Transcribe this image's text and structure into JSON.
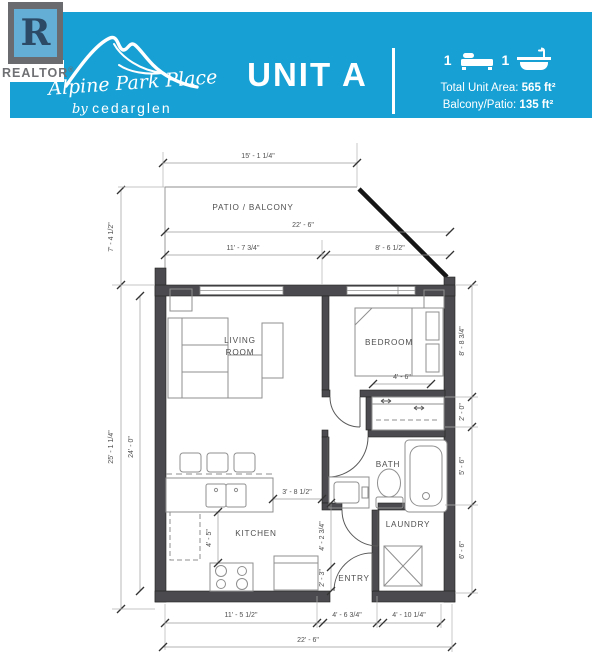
{
  "colors": {
    "accent_teal": "#16a0d4",
    "wall_gray": "#4b4b4f",
    "logo_blue": "#64aed6",
    "logo_gray": "#696b6e"
  },
  "header": {
    "unit_title": "UNIT A",
    "bed_count": "1",
    "bath_count": "1",
    "total_area_label": "Total Unit Area:",
    "total_area_value": "565 ft²",
    "balcony_label": "Balcony/Patio:",
    "balcony_value": "135 ft²",
    "realtor_r": "R",
    "realtor_word": "REALTOR",
    "brand_name": "Alpine Park Place",
    "brand_by": "by",
    "brand_builder": "cedarglen"
  },
  "plan": {
    "rooms": {
      "patio": "PATIO / BALCONY",
      "living_1": "LIVING",
      "living_2": "ROOM",
      "bedroom": "BEDROOM",
      "kitchen": "KITCHEN",
      "bath": "BATH",
      "laundry": "LAUNDRY",
      "entry": "ENTRY"
    },
    "dims": {
      "top_width": "15' - 1 1/4\"",
      "patio_depth": "7' - 4 1/2\"",
      "patio_width": "22' - 6\"",
      "living_width": "11' - 7 3/4\"",
      "bedroom_width": "8' - 6 1/2\"",
      "left_overall": "25' - 1 1/4\"",
      "left_inner": "24' - 0\"",
      "closet_width": "4' - 6\"",
      "right_bedroom": "8' - 8 3/4\"",
      "right_closet": "2' - 0\"",
      "right_bath": "5' - 6\"",
      "right_laundry": "6' - 6\"",
      "kitchen_pass": "3' - 8 1/2\"",
      "kitchen_depth": "4' - 5\"",
      "hall_depth": "4' - 2 3/4\"",
      "entry_depth": "2' - 3\"",
      "bottom_left": "11' - 5 1/2\"",
      "bottom_entry": "4' - 6 3/4\"",
      "bottom_right": "4' - 10 1/4\"",
      "bottom_overall": "22' - 6\""
    }
  }
}
